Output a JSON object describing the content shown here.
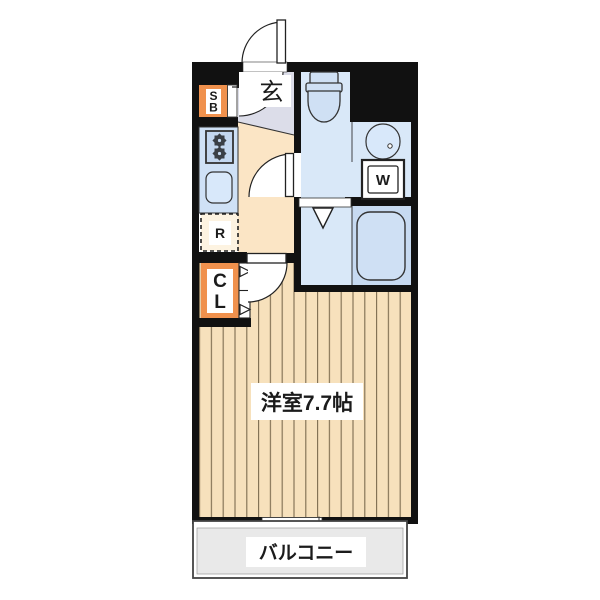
{
  "floor_plan": {
    "labels": {
      "entrance": "玄",
      "shoe_box": "SB",
      "refrigerator": "R",
      "closet": "CL",
      "washer": "W",
      "main_room": "洋室7.7帖",
      "balcony": "バルコニー"
    },
    "colors": {
      "wall": "#111111",
      "entrance_floor": "#dcdde9",
      "hall_floor": "#fbe5c5",
      "wood_floor": "#f7e1bc",
      "wood_stripe": "#7d6c50",
      "wet_floor": "#d9e8f8",
      "bathtub_zone": "#c7daf1",
      "fixture_blue": "#cfe0f4",
      "kitchen_counter": "#cfe1f6",
      "stove_fill": "#c3d7f0",
      "sink_fill": "#d8e8fa",
      "accent_orange": "#f0914d",
      "refrigerator_fill": "#fdf3e1",
      "balcony_fill": "#e9e9e9"
    }
  }
}
